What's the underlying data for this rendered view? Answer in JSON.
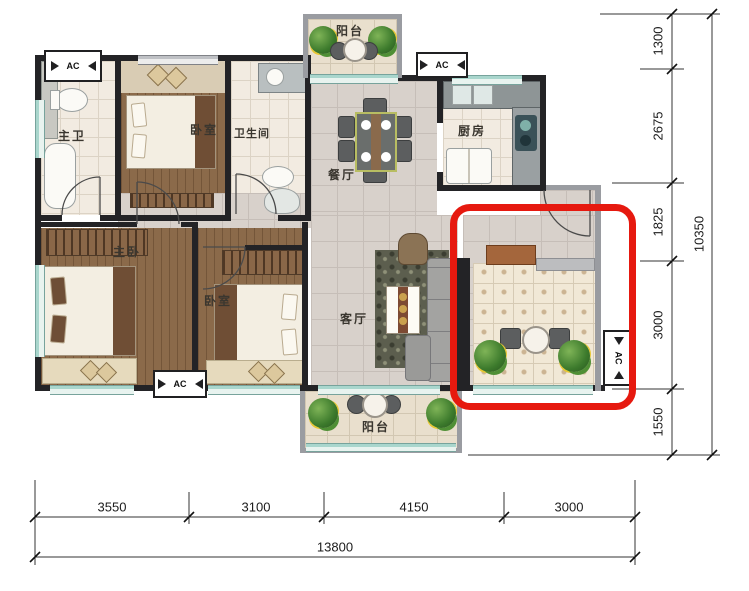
{
  "title": "apartment-floor-plan",
  "colors": {
    "highlight_box": "#e6190f",
    "wall": "#232326",
    "wood_floor": "#8b6a4a",
    "tile_floor": "#d8d1cb",
    "bath_tile": "#f2ebe1",
    "window_glass": "#a9d6cd"
  },
  "rooms": {
    "master_bath": {
      "label": "主卫"
    },
    "bedroom_top": {
      "label": "卧室"
    },
    "bathroom": {
      "label": "卫生间"
    },
    "dining": {
      "label": "餐厅"
    },
    "kitchen": {
      "label": "厨房"
    },
    "master_bedroom": {
      "label": "主卧"
    },
    "bedroom_second": {
      "label": "卧室"
    },
    "living": {
      "label": "客厅"
    },
    "balcony_top": {
      "label": "阳台"
    },
    "balcony_bottom": {
      "label": "阳台"
    }
  },
  "ac_label": "AC",
  "dimensions": {
    "right": {
      "segments": [
        "1300",
        "2675",
        "1825",
        "3000",
        "1550"
      ],
      "total": "10350"
    },
    "bottom": {
      "segments": [
        "3550",
        "3100",
        "4150",
        "3000"
      ],
      "total": "13800"
    }
  }
}
